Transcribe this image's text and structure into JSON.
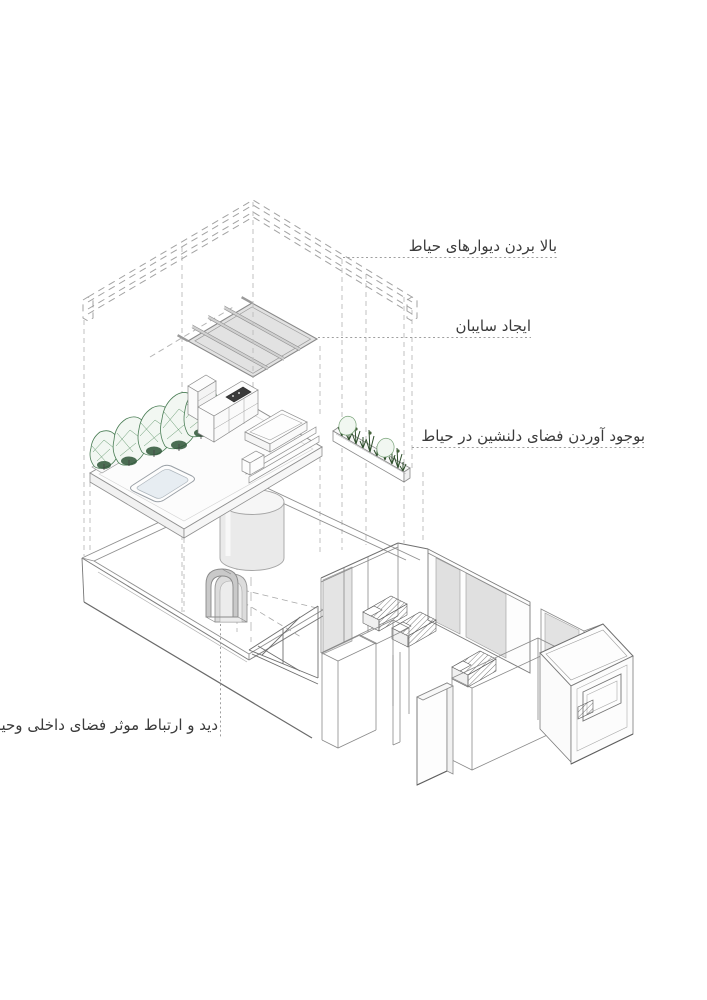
{
  "diagram": {
    "type": "architectural-exploded-axonometric",
    "labels": {
      "raise_walls": "بالا بردن دیوارهای حیاط",
      "create_canopy": "ایجاد سایبان",
      "pleasant_space": "بوجود آوردن فضای دلنشین در حیاط",
      "view_connection": "دید و ارتباط موثر فضای داخلی وحیاط"
    },
    "components": [
      "raised-courtyard-walls-outline",
      "canopy-panel",
      "roof-terrace",
      "trees",
      "pool",
      "outdoor-kitchen",
      "bench-steps",
      "planter-tray",
      "wall-planter-plants",
      "skylight-cylinder",
      "courtyard",
      "arched-doorway",
      "house-interior",
      "beds",
      "window-opening"
    ],
    "colors": {
      "background": "#ffffff",
      "projection_line": "#bcbcbc",
      "line_mid": "#8f8f8f",
      "line_dark": "#5f5f5f",
      "glass": "#e2e2e2",
      "canopy_fill": "#e4e4e4",
      "tree_green": "#4a7d55",
      "plant_green": "#2f4f2c",
      "pool_water": "#e7edf2",
      "arch_gray": "#c9c9c9",
      "text": "#3b3b3b"
    }
  }
}
